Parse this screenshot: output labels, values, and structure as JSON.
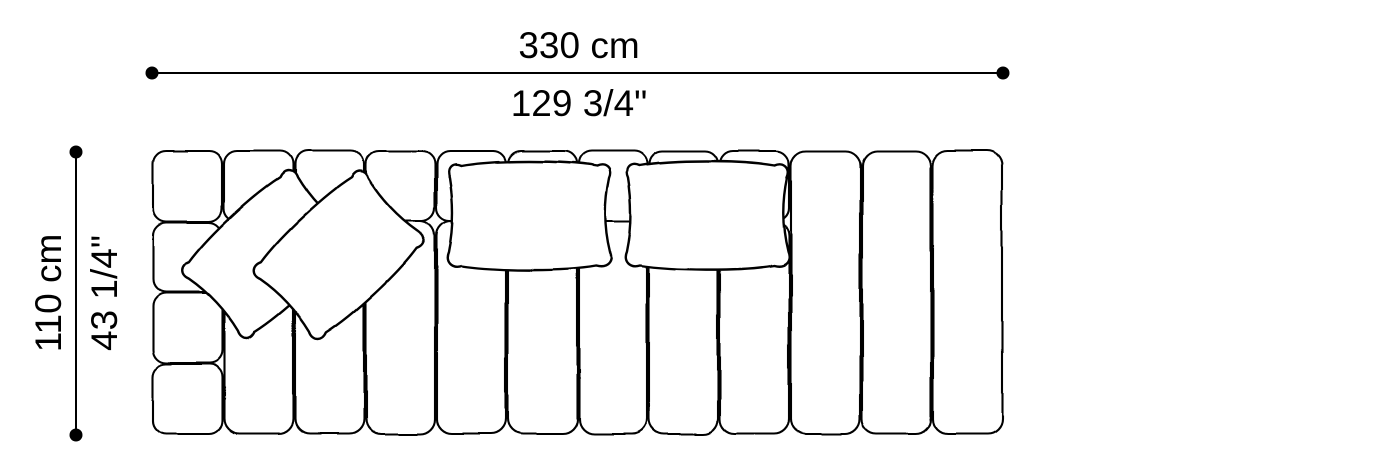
{
  "page": {
    "background": "#ffffff"
  },
  "drawing": {
    "type": "sofa-top-view-dimension-diagram",
    "line_color": "#000000",
    "fill_color": "#ffffff",
    "width_dimension": {
      "metric_label": "330 cm",
      "imperial_label": "129 3/4\"",
      "metric_value": 330,
      "metric_unit": "cm",
      "imperial_value": "129 3/4",
      "imperial_unit": "\""
    },
    "depth_dimension": {
      "metric_label": "110 cm",
      "imperial_label": "43 1/4\"",
      "metric_value": 110,
      "metric_unit": "cm",
      "imperial_value": "43 1/4",
      "imperial_unit": "\""
    }
  }
}
